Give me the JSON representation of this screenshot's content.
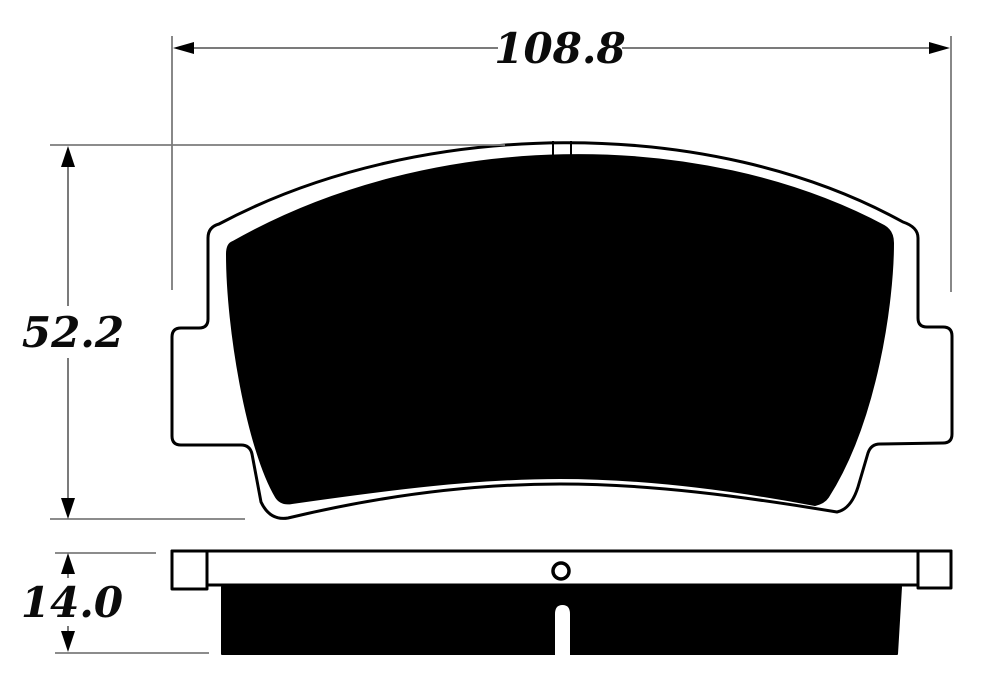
{
  "diagram": {
    "type": "technical-drawing",
    "part": "brake-pad",
    "views": {
      "front": "front-profile-with-friction-material",
      "side": "edge-profile-with-mounting-hole-and-wear-slot"
    },
    "dimensions": {
      "overall_width": "108.8",
      "overall_height": "52.2",
      "thickness": "14.0"
    },
    "colors": {
      "background": "#ffffff",
      "outline": "#000000",
      "friction_fill": "#000000",
      "dimension_line": "#7b7b7b",
      "label_text": "#0b0b0b"
    }
  }
}
